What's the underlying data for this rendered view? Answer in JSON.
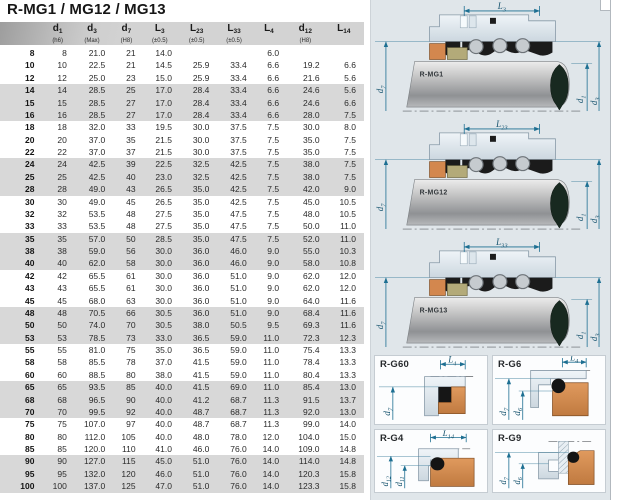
{
  "title": "R-MG1 / MG12 / MG13",
  "table": {
    "columns": [
      {
        "base": "",
        "sub": "",
        "tol": ""
      },
      {
        "base": "d",
        "sub": "1",
        "tol": "(h6)"
      },
      {
        "base": "d",
        "sub": "3",
        "tol": "(Max)"
      },
      {
        "base": "d",
        "sub": "7",
        "tol": "(H8)"
      },
      {
        "base": "L",
        "sub": "3",
        "tol": "(±0.5)"
      },
      {
        "base": "L",
        "sub": "23",
        "tol": "(±0.5)"
      },
      {
        "base": "L",
        "sub": "33",
        "tol": "(±0.5)"
      },
      {
        "base": "L",
        "sub": "4",
        "tol": ""
      },
      {
        "base": "d",
        "sub": "12",
        "tol": "(H8)"
      },
      {
        "base": "L",
        "sub": "14",
        "tol": ""
      }
    ],
    "rows": [
      [
        "8",
        "8",
        "21.0",
        "21",
        "14.0",
        "",
        "",
        "6.0",
        "",
        ""
      ],
      [
        "10",
        "10",
        "22.5",
        "21",
        "14.5",
        "25.9",
        "33.4",
        "6.6",
        "19.2",
        "6.6"
      ],
      [
        "12",
        "12",
        "25.0",
        "23",
        "15.0",
        "25.9",
        "33.4",
        "6.6",
        "21.6",
        "5.6"
      ],
      [
        "14",
        "14",
        "28.5",
        "25",
        "17.0",
        "28.4",
        "33.4",
        "6.6",
        "24.6",
        "5.6"
      ],
      [
        "15",
        "15",
        "28.5",
        "27",
        "17.0",
        "28.4",
        "33.4",
        "6.6",
        "24.6",
        "6.6"
      ],
      [
        "16",
        "16",
        "28.5",
        "27",
        "17.0",
        "28.4",
        "33.4",
        "6.6",
        "28.0",
        "7.5"
      ],
      [
        "18",
        "18",
        "32.0",
        "33",
        "19.5",
        "30.0",
        "37.5",
        "7.5",
        "30.0",
        "8.0"
      ],
      [
        "20",
        "20",
        "37.0",
        "35",
        "21.5",
        "30.0",
        "37.5",
        "7.5",
        "35.0",
        "7.5"
      ],
      [
        "22",
        "22",
        "37.0",
        "37",
        "21.5",
        "30.0",
        "37.5",
        "7.5",
        "35.0",
        "7.5"
      ],
      [
        "24",
        "24",
        "42.5",
        "39",
        "22.5",
        "32.5",
        "42.5",
        "7.5",
        "38.0",
        "7.5"
      ],
      [
        "25",
        "25",
        "42.5",
        "40",
        "23.0",
        "32.5",
        "42.5",
        "7.5",
        "38.0",
        "7.5"
      ],
      [
        "28",
        "28",
        "49.0",
        "43",
        "26.5",
        "35.0",
        "42.5",
        "7.5",
        "42.0",
        "9.0"
      ],
      [
        "30",
        "30",
        "49.0",
        "45",
        "26.5",
        "35.0",
        "42.5",
        "7.5",
        "45.0",
        "10.5"
      ],
      [
        "32",
        "32",
        "53.5",
        "48",
        "27.5",
        "35.0",
        "47.5",
        "7.5",
        "48.0",
        "10.5"
      ],
      [
        "33",
        "33",
        "53.5",
        "48",
        "27.5",
        "35.0",
        "47.5",
        "7.5",
        "50.0",
        "11.0"
      ],
      [
        "35",
        "35",
        "57.0",
        "50",
        "28.5",
        "35.0",
        "47.5",
        "7.5",
        "52.0",
        "11.0"
      ],
      [
        "38",
        "38",
        "59.0",
        "56",
        "30.0",
        "36.0",
        "46.0",
        "9.0",
        "55.0",
        "10.3"
      ],
      [
        "40",
        "40",
        "62.0",
        "58",
        "30.0",
        "36.0",
        "46.0",
        "9.0",
        "58.0",
        "10.8"
      ],
      [
        "42",
        "42",
        "65.5",
        "61",
        "30.0",
        "36.0",
        "51.0",
        "9.0",
        "62.0",
        "12.0"
      ],
      [
        "43",
        "43",
        "65.5",
        "61",
        "30.0",
        "36.0",
        "51.0",
        "9.0",
        "62.0",
        "12.0"
      ],
      [
        "45",
        "45",
        "68.0",
        "63",
        "30.0",
        "36.0",
        "51.0",
        "9.0",
        "64.0",
        "11.6"
      ],
      [
        "48",
        "48",
        "70.5",
        "66",
        "30.5",
        "36.0",
        "51.0",
        "9.0",
        "68.4",
        "11.6"
      ],
      [
        "50",
        "50",
        "74.0",
        "70",
        "30.5",
        "38.0",
        "50.5",
        "9.5",
        "69.3",
        "11.6"
      ],
      [
        "53",
        "53",
        "78.5",
        "73",
        "33.0",
        "36.5",
        "59.0",
        "11.0",
        "72.3",
        "12.3"
      ],
      [
        "55",
        "55",
        "81.0",
        "75",
        "35.0",
        "36.5",
        "59.0",
        "11.0",
        "75.4",
        "13.3"
      ],
      [
        "58",
        "58",
        "85.5",
        "78",
        "37.0",
        "41.5",
        "59.0",
        "11.0",
        "78.4",
        "13.3"
      ],
      [
        "60",
        "60",
        "88.5",
        "80",
        "38.0",
        "41.5",
        "59.0",
        "11.0",
        "80.4",
        "13.3"
      ],
      [
        "65",
        "65",
        "93.5",
        "85",
        "40.0",
        "41.5",
        "69.0",
        "11.0",
        "85.4",
        "13.0"
      ],
      [
        "68",
        "68",
        "96.5",
        "90",
        "40.0",
        "41.2",
        "68.7",
        "11.3",
        "91.5",
        "13.7"
      ],
      [
        "70",
        "70",
        "99.5",
        "92",
        "40.0",
        "48.7",
        "68.7",
        "11.3",
        "92.0",
        "13.0"
      ],
      [
        "75",
        "75",
        "107.0",
        "97",
        "40.0",
        "48.7",
        "68.7",
        "11.3",
        "99.0",
        "14.0"
      ],
      [
        "80",
        "80",
        "112.0",
        "105",
        "40.0",
        "48.0",
        "78.0",
        "12.0",
        "104.0",
        "15.0"
      ],
      [
        "85",
        "85",
        "120.0",
        "110",
        "41.0",
        "46.0",
        "76.0",
        "14.0",
        "109.0",
        "14.8"
      ],
      [
        "90",
        "90",
        "127.0",
        "115",
        "45.0",
        "51.0",
        "76.0",
        "14.0",
        "114.0",
        "14.8"
      ],
      [
        "95",
        "95",
        "132.0",
        "120",
        "46.0",
        "51.0",
        "76.0",
        "14.0",
        "120.3",
        "15.8"
      ],
      [
        "100",
        "100",
        "137.0",
        "125",
        "47.0",
        "51.0",
        "76.0",
        "14.0",
        "123.3",
        "15.8"
      ]
    ]
  },
  "diagrams": [
    {
      "label": "R-MG1",
      "dim_top": {
        "base": "L",
        "sub": "3"
      },
      "dim_left": {
        "base": "d",
        "sub": "7"
      },
      "dims_right": [
        {
          "base": "d",
          "sub": "1"
        },
        {
          "base": "d",
          "sub": "3"
        }
      ],
      "part_labels": [
        "3",
        "2",
        "1",
        "5",
        "3",
        "4",
        "5"
      ]
    },
    {
      "label": "R-MG12",
      "dim_top": {
        "base": "L",
        "sub": "23"
      },
      "dim_left": {
        "base": "d",
        "sub": "7"
      },
      "dims_right": [
        {
          "base": "d",
          "sub": "1"
        },
        {
          "base": "d",
          "sub": "3"
        }
      ],
      "part_labels": [
        "3",
        "2",
        "1",
        "5",
        "3",
        "4",
        "5"
      ]
    },
    {
      "label": "R-MG13",
      "dim_top": {
        "base": "L",
        "sub": "33"
      },
      "dim_left": {
        "base": "d",
        "sub": "7"
      },
      "dims_right": [
        {
          "base": "d",
          "sub": "1"
        },
        {
          "base": "d",
          "sub": "3"
        }
      ],
      "part_labels": [
        "3",
        "2",
        "1",
        "5",
        "3",
        "4",
        "5"
      ]
    }
  ],
  "seat_panels": [
    {
      "label": "R-G60",
      "dim_top": {
        "base": "L",
        "sub": "4"
      },
      "dims_left": [
        {
          "base": "d",
          "sub": "7"
        }
      ]
    },
    {
      "label": "R-G6",
      "dim_top": {
        "base": "L",
        "sub": "4"
      },
      "dims_left": [
        {
          "base": "d",
          "sub": "7"
        },
        {
          "base": "d",
          "sub": "6"
        }
      ]
    },
    {
      "label": "R-G4",
      "dim_top": {
        "base": "L",
        "sub": "14"
      },
      "dims_left": [
        {
          "base": "d",
          "sub": "12"
        },
        {
          "base": "d",
          "sub": "11"
        }
      ]
    },
    {
      "label": "R-G9",
      "dim_top": null,
      "dims_left": [
        {
          "base": "d",
          "sub": "7"
        },
        {
          "base": "d",
          "sub": "6"
        }
      ]
    }
  ],
  "colors": {
    "dim_accent": "#1d6f92",
    "chip_gold": "#d9a83c",
    "seat_copper": "#d3874e",
    "face_olive": "#b3aa79",
    "elastomer": "#1b1b1b",
    "metal_light": "#dfe7ee",
    "panel_bg": "#e0e6ea",
    "row_stripe": "#d8d8d8",
    "header_band": "#d2d2d2"
  }
}
